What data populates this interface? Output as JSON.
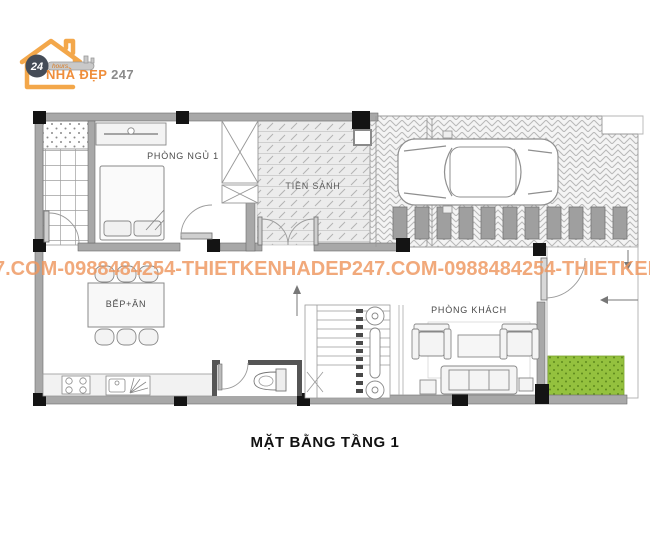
{
  "logo": {
    "badge_number": "24",
    "badge_unit": "hours",
    "brand": "NHÀ ĐẸP ",
    "brand_suffix": "247"
  },
  "watermark": {
    "text": "7.COM-0988484254-THIETKENHADEP247.COM-0988484254-THIETKENHADEP2"
  },
  "plan": {
    "rooms": [
      {
        "id": "bedroom-1",
        "label": "PHÒNG NGỦ 1"
      },
      {
        "id": "entrance-hall",
        "label": "TIỀN SẢNH"
      },
      {
        "id": "kitchen-dining",
        "label": "BẾP+ĂN"
      },
      {
        "id": "living-room",
        "label": "PHÒNG KHÁCH"
      }
    ]
  },
  "title": "MẶT BẰNG TẦNG 1",
  "colors": {
    "accent_orange": "#F2994A",
    "watermark_orange": "#EF9C63",
    "wall_gray": "#A8A8A8",
    "grass_green": "#94C13E"
  }
}
